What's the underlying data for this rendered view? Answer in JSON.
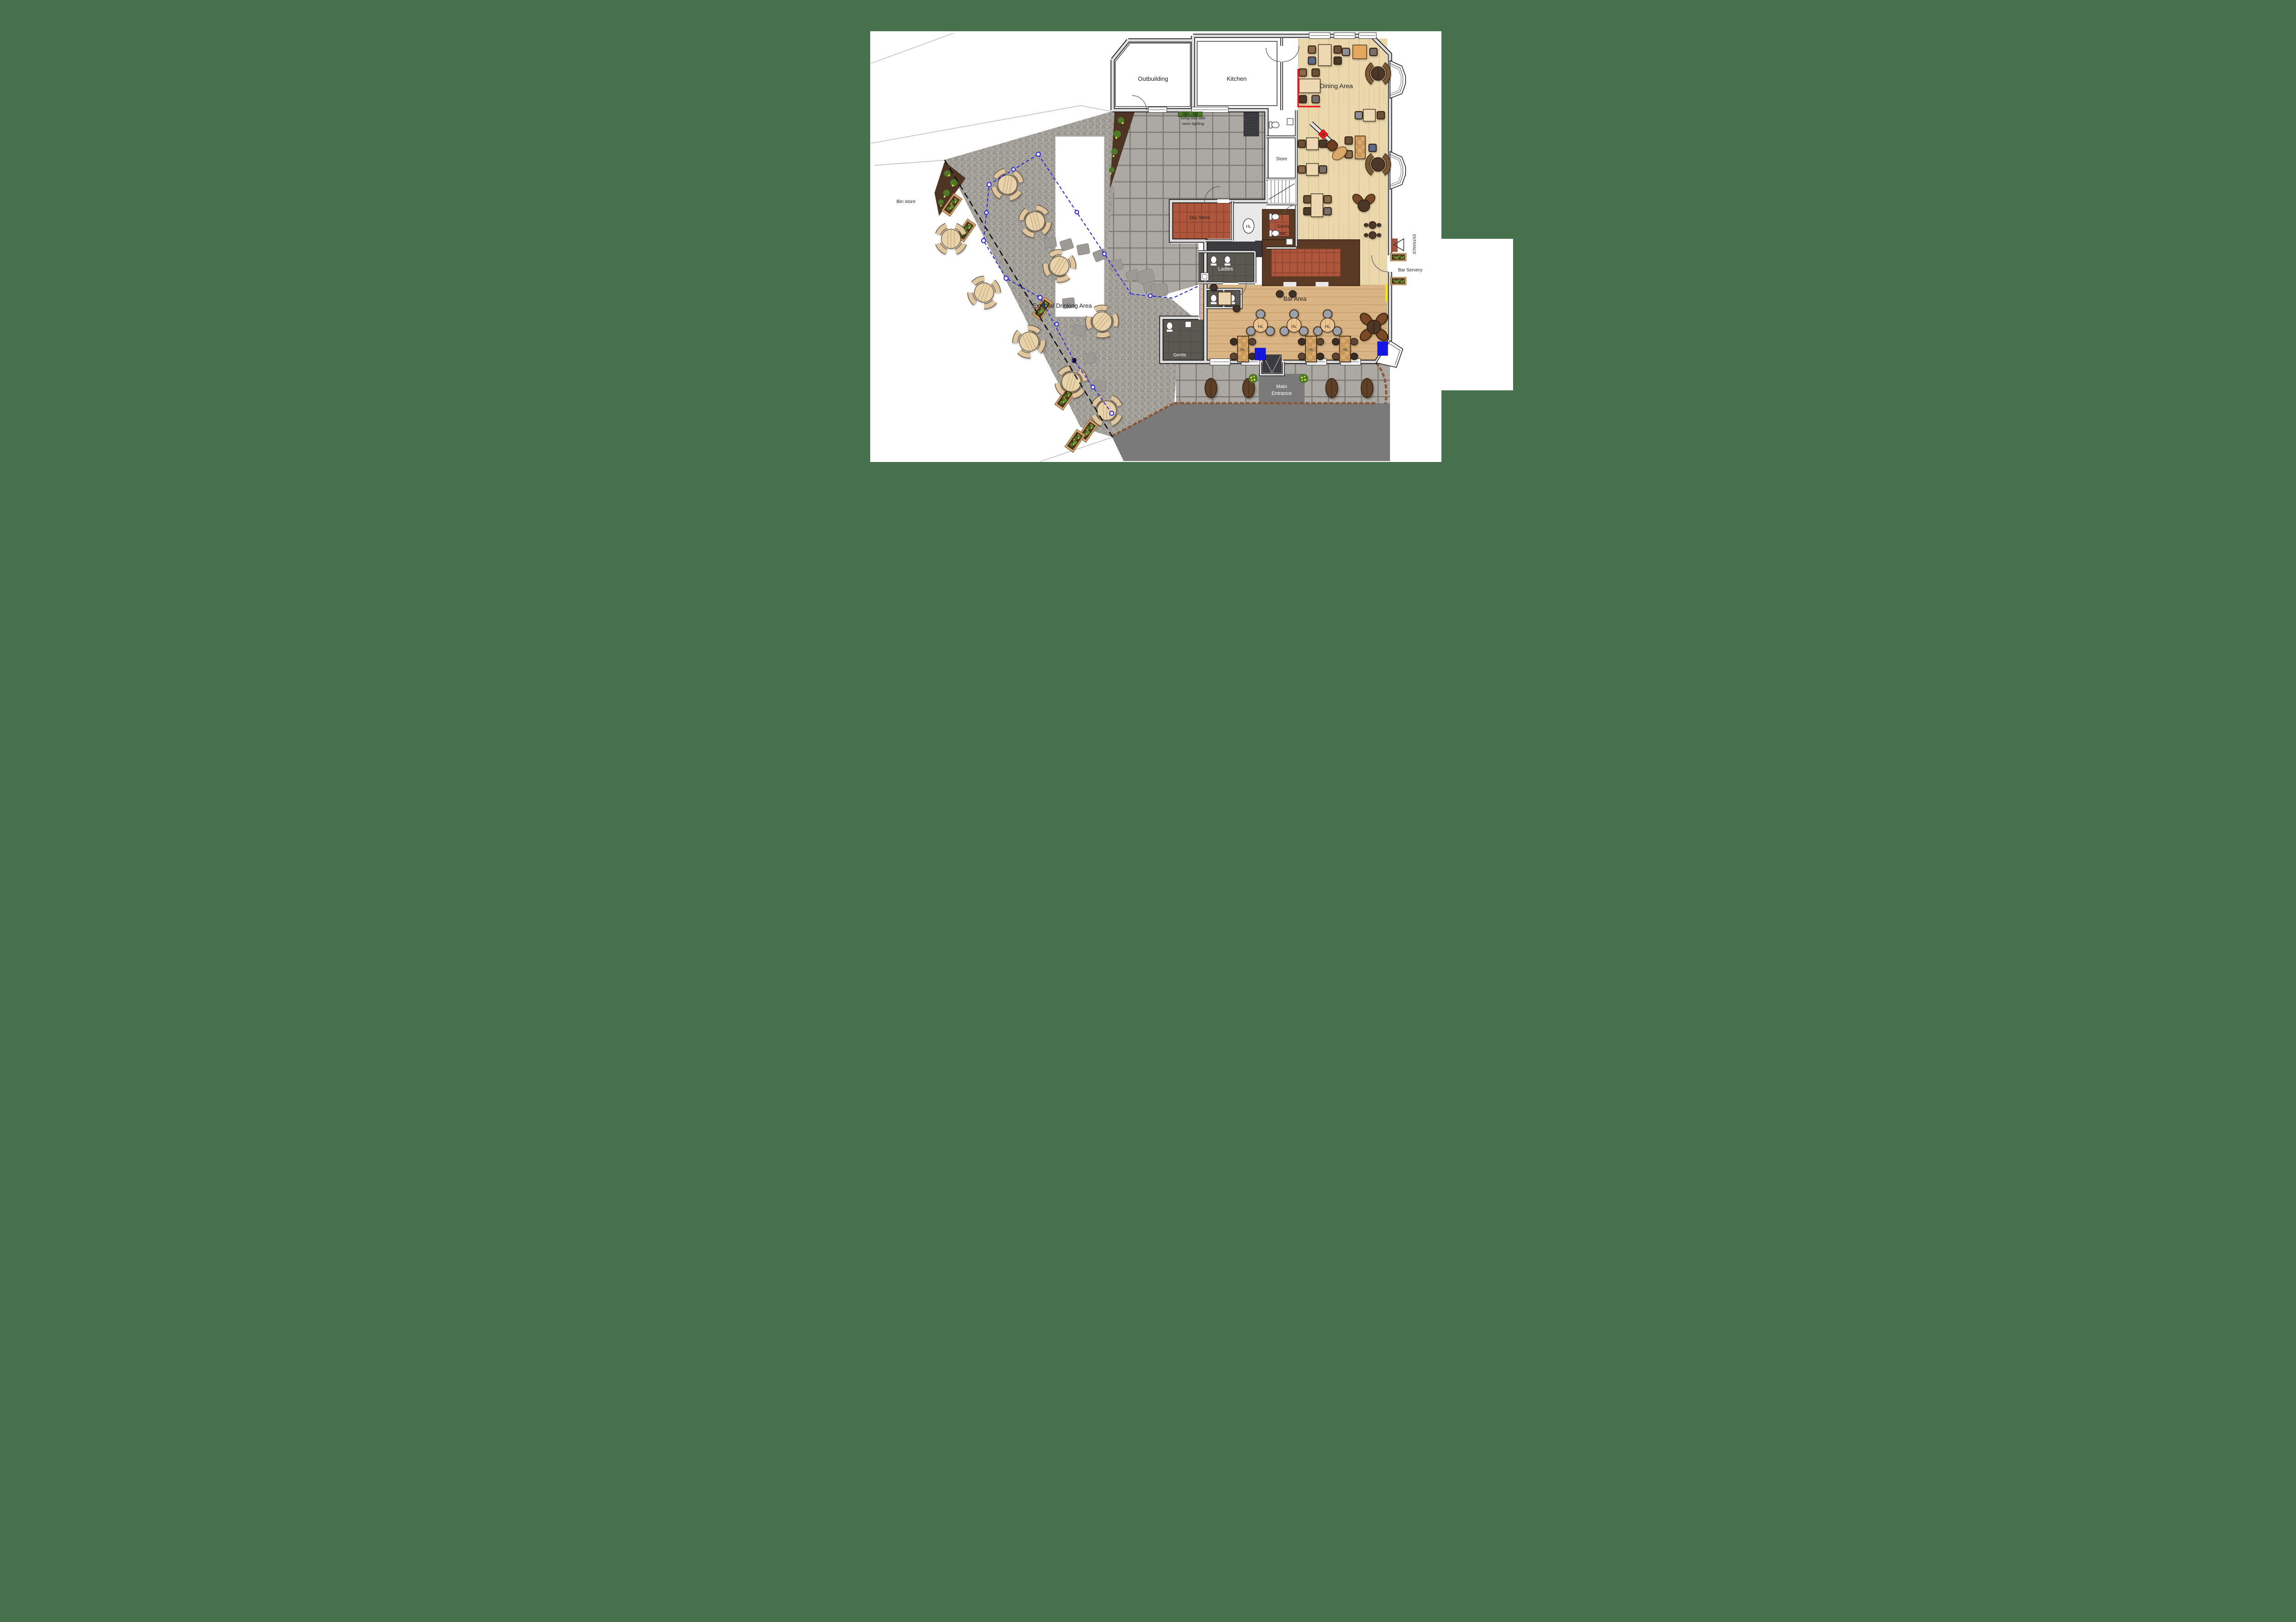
{
  "labels": {
    "outbuilding": "Outbuilding",
    "kitchen": "Kitchen",
    "dining_area": "Dining Area",
    "store": "Store",
    "dry_store": "Dry Store",
    "gents_wc_line1": "Gents",
    "gents_wc_line2": "WC",
    "ladies": "Ladies",
    "gents": "Gents",
    "bar_area": "Bar Area",
    "bar_servery": "Bar Servery",
    "entrance_side": "ENTRANCE",
    "main_entrance_line1": "Main",
    "main_entrance_line2": "Entrance",
    "external_drinking_area": "External Drinking Area",
    "bin_store": "Bin store",
    "living_wall_line1": "living wall with",
    "living_wall_line2": "neon lighting"
  },
  "markers": {
    "high_level": "HL",
    "fire_point": "FP",
    "gaming_machine": "AWP"
  },
  "colors": {
    "background_green": "#47714d",
    "page_white": "#ffffff",
    "gravel": "#a5a19b",
    "paving_slab": "#a9a5a0",
    "wood_dining": "#ead7ac",
    "wood_bar": "#d9b585",
    "bar_counter_wood": "#5a3a24",
    "quarry_tile_red": "#ae573d",
    "dark_floor": "#5b5852",
    "charcoal_mat": "#3b3b3f",
    "wall_grey": "#dedede",
    "boundary_blue": "#2020e8",
    "safety_yellow": "#f6e900",
    "fire_red": "#e81c1c",
    "machine_blue": "#1616e8",
    "planting_green": "#4e7a28",
    "flower_yellow": "#e6e23c",
    "path_dark_grey": "#7a7a7a"
  }
}
